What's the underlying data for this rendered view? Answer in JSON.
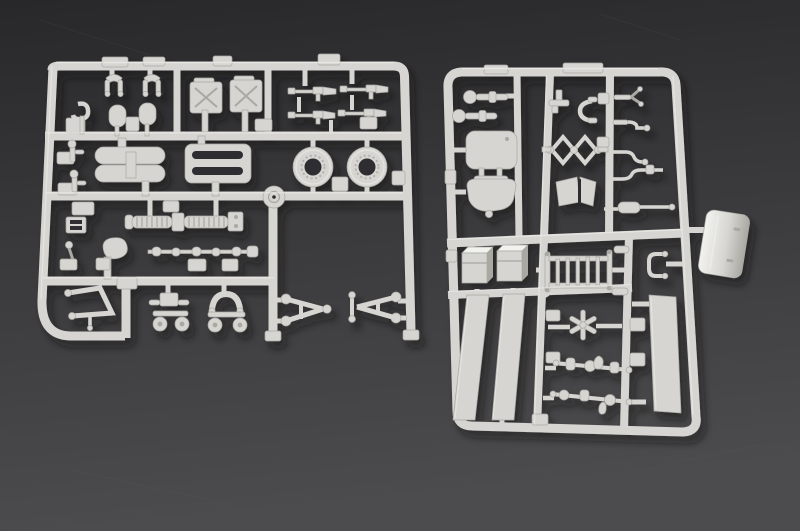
{
  "scene": {
    "type": "product-photo",
    "subject": "Two light gray injection-molded plastic model kit sprues with unassembled parts, photographed on a dark gray surface",
    "colors": {
      "background_top": "#28282a",
      "background_mid": "#39393b",
      "background_bottom": "#4c4c4e",
      "plastic": "#d6d5d1",
      "plastic_highlight": "#f2f2ef",
      "plastic_shadow": "#a9a8a3",
      "hole": "#2e2e30",
      "cast_shadow": "#141416"
    },
    "sprues": [
      {
        "id": "sprue-left",
        "position": "left",
        "parts": [
          {
            "name": "clevis-fork",
            "count": 2
          },
          {
            "name": "tow-hook",
            "count": 1
          },
          {
            "name": "shovel-blade",
            "count": 2
          },
          {
            "name": "jerry-can",
            "count": 2
          },
          {
            "name": "machine-gun",
            "count": 4
          },
          {
            "name": "pontoon-float",
            "count": 1
          },
          {
            "name": "slotted-rack",
            "count": 1
          },
          {
            "name": "road-wheel-ring",
            "count": 2
          },
          {
            "name": "gate-disc",
            "count": 1
          },
          {
            "name": "shift-lever",
            "count": 2
          },
          {
            "name": "belt-buckle",
            "count": 1
          },
          {
            "name": "hand-lever",
            "count": 1
          },
          {
            "name": "seat-pan",
            "count": 1
          },
          {
            "name": "torsion-spring-axle",
            "count": 1
          },
          {
            "name": "linkage-rod",
            "count": 1
          },
          {
            "name": "z-frame-bracket",
            "count": 1
          },
          {
            "name": "wheel-bogie",
            "count": 2
          },
          {
            "name": "a-frame-arm",
            "count": 2
          }
        ]
      },
      {
        "id": "sprue-right",
        "position": "right",
        "parts": [
          {
            "name": "ball-axle",
            "count": 2
          },
          {
            "name": "seat-backrest",
            "count": 1
          },
          {
            "name": "seat-base",
            "count": 1
          },
          {
            "name": "t-bracket",
            "count": 1
          },
          {
            "name": "c-clamp",
            "count": 1
          },
          {
            "name": "scissor-linkage",
            "count": 1
          },
          {
            "name": "folded-plate",
            "count": 1
          },
          {
            "name": "crank-lever",
            "count": 5
          },
          {
            "name": "ammo-box",
            "count": 2
          },
          {
            "name": "ladder-grate",
            "count": 1
          },
          {
            "name": "stirrup-bracket",
            "count": 1
          },
          {
            "name": "curved-fender",
            "count": 1
          },
          {
            "name": "flat-strip",
            "count": 3
          },
          {
            "name": "star-wheel",
            "count": 1
          },
          {
            "name": "axle-rod",
            "count": 2
          }
        ]
      }
    ]
  }
}
